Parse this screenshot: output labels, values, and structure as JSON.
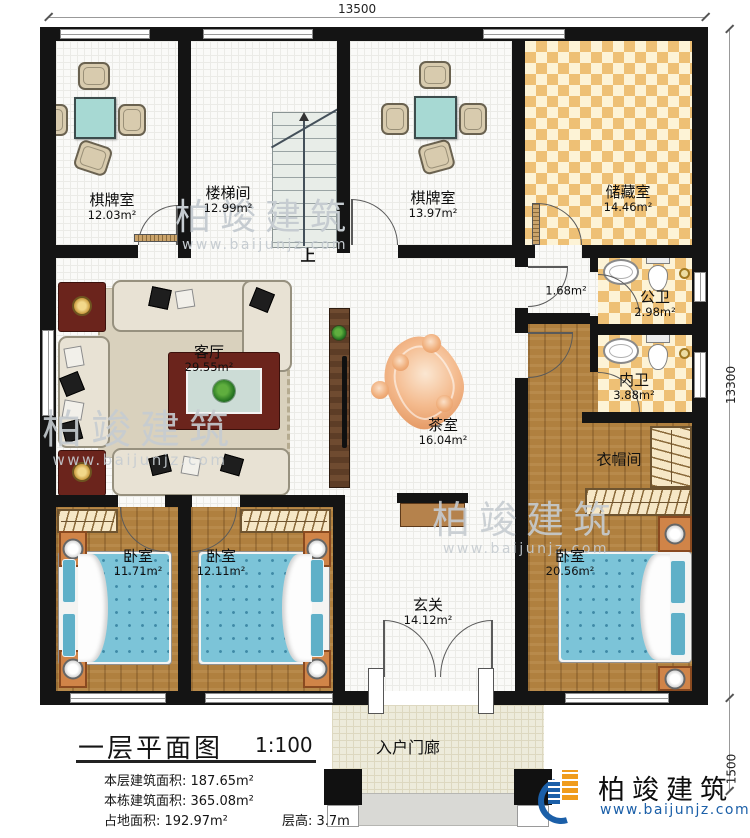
{
  "plan": {
    "dimensions": {
      "top": "13500",
      "right": "13300",
      "porch": "1500"
    },
    "stair": {
      "up_label": "上"
    },
    "rooms": [
      {
        "name": "棋牌室",
        "area": "12.03m²"
      },
      {
        "name": "楼梯间",
        "area": "12.99m²"
      },
      {
        "name": "棋牌室",
        "area": "13.97m²"
      },
      {
        "name": "储藏室",
        "area": "14.46m²"
      },
      {
        "name": "",
        "area": "1.68m²"
      },
      {
        "name": "公卫",
        "area": "2.98m²"
      },
      {
        "name": "内卫",
        "area": "3.88m²"
      },
      {
        "name": "衣帽间",
        "area": ""
      },
      {
        "name": "客厅",
        "area": "29.55m²"
      },
      {
        "name": "茶室",
        "area": "16.04m²"
      },
      {
        "name": "卧室",
        "area": "11.71m²"
      },
      {
        "name": "卧室",
        "area": "12.11m²"
      },
      {
        "name": "卧室",
        "area": "20.56m²"
      },
      {
        "name": "玄关",
        "area": "14.12m²"
      },
      {
        "name": "入户门廊",
        "area": ""
      }
    ],
    "title_block": {
      "title": "一层平面图",
      "scale": "1:100",
      "lines": [
        "本层建筑面积: 187.65m²",
        "本栋建筑面积: 365.08m²",
        "占地面积: 192.97m²",
        "层高: 3.7m"
      ]
    },
    "brand": {
      "name": "柏竣建筑",
      "site": "www.baijunjz.com"
    },
    "watermark": {
      "text": "柏竣建筑",
      "site": "www.baijunjz.com"
    },
    "colors": {
      "wall": "#141414",
      "checker_dark": "#eec075",
      "checker_light": "#fdf3d6",
      "wood_floor": "#b0803f",
      "bed_fabric": "#7cc4d8",
      "brand_blue": "#1b5fa8",
      "brand_orange": "#f09c1c"
    }
  }
}
